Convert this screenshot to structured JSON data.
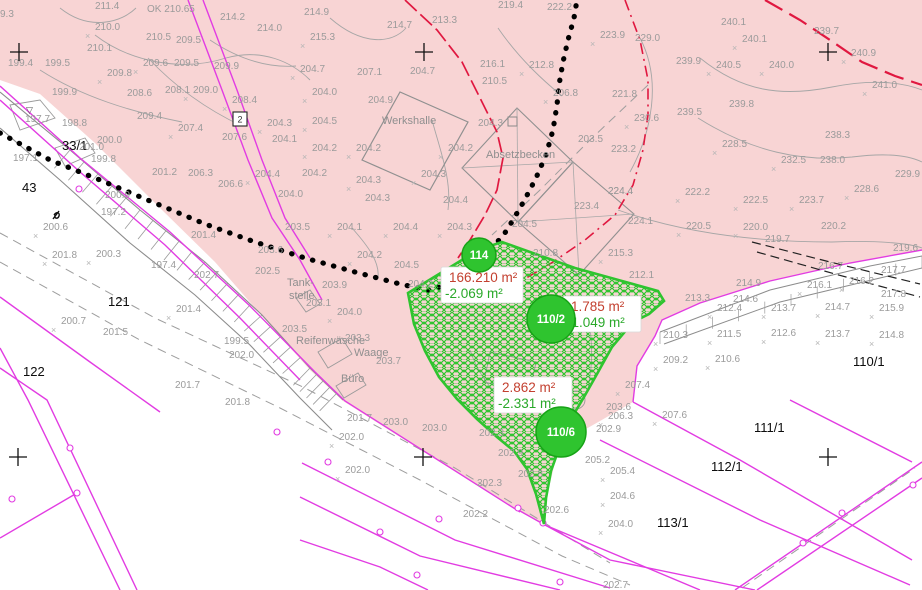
{
  "app": {
    "title": "Kataster-/Lageplan Kartenausschnitt"
  },
  "colors": {
    "background": "#ffffff",
    "area_fill_pink": "#f8d4d4",
    "parcel_line_magenta": "#e23ce2",
    "terrain_gray": "#9b9b9b",
    "survey_green": "#2fc42f",
    "area_label_red": "#c3402f",
    "area_label_green": "#29a829",
    "boundary_black": "#000000",
    "red_line": "#e01840"
  },
  "area_labels": [
    {
      "main": "166.210 m²",
      "delta": "-2.069 m²",
      "x": 441,
      "y": 267,
      "w": 82,
      "h": 36
    },
    {
      "main": "1.785 m²",
      "delta": "-1.049 m²",
      "x": 563,
      "y": 296,
      "w": 78,
      "h": 36
    },
    {
      "main": "2.862 m²",
      "delta": "-2.331 m²",
      "x": 494,
      "y": 377,
      "w": 78,
      "h": 36
    }
  ],
  "markers": {
    "circles": [
      {
        "label": "114",
        "x": 479,
        "y": 255,
        "r": 17
      },
      {
        "label": "110/2",
        "x": 551,
        "y": 319,
        "r": 24
      },
      {
        "label": "110/6",
        "x": 561,
        "y": 432,
        "r": 25
      }
    ],
    "grid_crosses": [
      {
        "x": 19,
        "y": 52
      },
      {
        "x": 424,
        "y": 52
      },
      {
        "x": 828,
        "y": 52
      },
      {
        "x": 18,
        "y": 457
      },
      {
        "x": 423,
        "y": 457
      },
      {
        "x": 828,
        "y": 457
      }
    ],
    "benchmark": {
      "glyph": "▽",
      "x": 31,
      "y": 113
    },
    "boxed_symbol": {
      "glyph": "2",
      "x": 233,
      "y": 112
    }
  },
  "labels": [
    {
      "t": "9.3",
      "x": 0,
      "y": 17,
      "c": "e"
    },
    {
      "t": "211.4",
      "x": 95,
      "y": 9,
      "c": "e"
    },
    {
      "t": "OK 210.65",
      "x": 147,
      "y": 12,
      "c": "ok"
    },
    {
      "t": "210.0",
      "x": 95,
      "y": 30,
      "c": "e",
      "m": 1
    },
    {
      "t": "214.2",
      "x": 220,
      "y": 20,
      "c": "e"
    },
    {
      "t": "214.0",
      "x": 257,
      "y": 31,
      "c": "e"
    },
    {
      "t": "210.5",
      "x": 146,
      "y": 40,
      "c": "e"
    },
    {
      "t": "209.5",
      "x": 176,
      "y": 43,
      "c": "e"
    },
    {
      "t": "210.1",
      "x": 87,
      "y": 51,
      "c": "e"
    },
    {
      "t": "199.4",
      "x": 8,
      "y": 66,
      "c": "e"
    },
    {
      "t": "199.5",
      "x": 45,
      "y": 66,
      "c": "e"
    },
    {
      "t": "209.6",
      "x": 143,
      "y": 66,
      "c": "e",
      "m": 1
    },
    {
      "t": "209.5",
      "x": 174,
      "y": 66,
      "c": "e"
    },
    {
      "t": "209.9",
      "x": 214,
      "y": 69,
      "c": "e"
    },
    {
      "t": "209.8",
      "x": 107,
      "y": 76,
      "c": "e",
      "m": 1
    },
    {
      "t": "199.9",
      "x": 52,
      "y": 95,
      "c": "e"
    },
    {
      "t": "208.6",
      "x": 127,
      "y": 96,
      "c": "e"
    },
    {
      "t": "208.1",
      "x": 165,
      "y": 93,
      "c": "e"
    },
    {
      "t": "209.0",
      "x": 193,
      "y": 93,
      "c": "e",
      "m": 1
    },
    {
      "t": "208.4",
      "x": 232,
      "y": 103,
      "c": "e",
      "m": 1
    },
    {
      "t": "209.4",
      "x": 137,
      "y": 119,
      "c": "e"
    },
    {
      "t": "197.7",
      "x": 25,
      "y": 122,
      "c": "e"
    },
    {
      "t": "198.8",
      "x": 62,
      "y": 126,
      "c": "e"
    },
    {
      "t": "207.4",
      "x": 178,
      "y": 131,
      "c": "e",
      "m": 1
    },
    {
      "t": "207.6",
      "x": 222,
      "y": 140,
      "c": "e"
    },
    {
      "t": "204.3",
      "x": 267,
      "y": 126,
      "c": "e",
      "m": 1
    },
    {
      "t": "204.1",
      "x": 272,
      "y": 142,
      "c": "e"
    },
    {
      "t": "200.0",
      "x": 97,
      "y": 143,
      "c": "e"
    },
    {
      "t": "33/1",
      "x": 62,
      "y": 150,
      "c": "p"
    },
    {
      "t": "201.0",
      "x": 79,
      "y": 150,
      "c": "e"
    },
    {
      "t": "197.1",
      "x": 13,
      "y": 161,
      "c": "e"
    },
    {
      "t": "199.8",
      "x": 91,
      "y": 162,
      "c": "e"
    },
    {
      "t": "43",
      "x": 22,
      "y": 192,
      "c": "p"
    },
    {
      "t": "200.9",
      "x": 105,
      "y": 198,
      "c": "e"
    },
    {
      "t": "204.4",
      "x": 255,
      "y": 177,
      "c": "e",
      "m": 1
    },
    {
      "t": "206.6",
      "x": 218,
      "y": 187,
      "c": "e"
    },
    {
      "t": "206.3",
      "x": 188,
      "y": 176,
      "c": "e"
    },
    {
      "t": "201.2",
      "x": 152,
      "y": 175,
      "c": "e"
    },
    {
      "t": "204.0",
      "x": 278,
      "y": 197,
      "c": "e"
    },
    {
      "t": "214.9",
      "x": 304,
      "y": 15,
      "c": "e"
    },
    {
      "t": "214.7",
      "x": 387,
      "y": 28,
      "c": "e"
    },
    {
      "t": "213.3",
      "x": 432,
      "y": 23,
      "c": "e"
    },
    {
      "t": "215.3",
      "x": 310,
      "y": 40,
      "c": "e",
      "m": 1
    },
    {
      "t": "219.4",
      "x": 498,
      "y": 8,
      "c": "e"
    },
    {
      "t": "222.2",
      "x": 547,
      "y": 10,
      "c": "e"
    },
    {
      "t": "216.1",
      "x": 480,
      "y": 67,
      "c": "e"
    },
    {
      "t": "212.8",
      "x": 529,
      "y": 68,
      "c": "e",
      "m": 1
    },
    {
      "t": "210.5",
      "x": 482,
      "y": 84,
      "c": "e"
    },
    {
      "t": "206.8",
      "x": 553,
      "y": 96,
      "c": "e",
      "m": 1
    },
    {
      "t": "204.7",
      "x": 300,
      "y": 72,
      "c": "e",
      "m": 1
    },
    {
      "t": "207.1",
      "x": 357,
      "y": 75,
      "c": "e"
    },
    {
      "t": "204.7",
      "x": 410,
      "y": 74,
      "c": "e"
    },
    {
      "t": "204.0",
      "x": 312,
      "y": 95,
      "c": "e",
      "m": 1
    },
    {
      "t": "204.9",
      "x": 368,
      "y": 103,
      "c": "e"
    },
    {
      "t": "204.5",
      "x": 312,
      "y": 124,
      "c": "e",
      "m": 1
    },
    {
      "t": "Werkshalle",
      "x": 382,
      "y": 124,
      "c": "b"
    },
    {
      "t": "204.3",
      "x": 478,
      "y": 126,
      "c": "e"
    },
    {
      "t": "203.5",
      "x": 578,
      "y": 142,
      "c": "e"
    },
    {
      "t": "204.2",
      "x": 312,
      "y": 151,
      "c": "e",
      "m": 1
    },
    {
      "t": "204.2",
      "x": 356,
      "y": 151,
      "c": "e",
      "m": 1
    },
    {
      "t": "204.2",
      "x": 448,
      "y": 151,
      "c": "e",
      "m": 1
    },
    {
      "t": "Absetzbecken",
      "x": 486,
      "y": 158,
      "c": "b"
    },
    {
      "t": "223.2",
      "x": 611,
      "y": 152,
      "c": "e"
    },
    {
      "t": "204.2",
      "x": 302,
      "y": 176,
      "c": "e"
    },
    {
      "t": "204.3",
      "x": 356,
      "y": 183,
      "c": "e",
      "m": 1
    },
    {
      "t": "204.3",
      "x": 421,
      "y": 177,
      "c": "e",
      "m": 1
    },
    {
      "t": "204.3",
      "x": 365,
      "y": 201,
      "c": "e"
    },
    {
      "t": "204.4",
      "x": 443,
      "y": 203,
      "c": "e"
    },
    {
      "t": "223.4",
      "x": 574,
      "y": 209,
      "c": "e"
    },
    {
      "t": "224.4",
      "x": 608,
      "y": 194,
      "c": "e"
    },
    {
      "t": "223.9",
      "x": 600,
      "y": 38,
      "c": "e",
      "m": 1
    },
    {
      "t": "229.0",
      "x": 635,
      "y": 41,
      "c": "e"
    },
    {
      "t": "240.1",
      "x": 721,
      "y": 25,
      "c": "e"
    },
    {
      "t": "240.1",
      "x": 742,
      "y": 42,
      "c": "e",
      "m": 1
    },
    {
      "t": "239.7",
      "x": 814,
      "y": 34,
      "c": "e"
    },
    {
      "t": "240.9",
      "x": 851,
      "y": 56,
      "c": "e",
      "m": 1
    },
    {
      "t": "239.9",
      "x": 676,
      "y": 64,
      "c": "e"
    },
    {
      "t": "240.5",
      "x": 716,
      "y": 68,
      "c": "e",
      "m": 1
    },
    {
      "t": "240.0",
      "x": 769,
      "y": 68,
      "c": "e",
      "m": 1
    },
    {
      "t": "241.0",
      "x": 872,
      "y": 88,
      "c": "e",
      "m": 1
    },
    {
      "t": "221.8",
      "x": 612,
      "y": 97,
      "c": "e"
    },
    {
      "t": "239.5",
      "x": 677,
      "y": 115,
      "c": "e"
    },
    {
      "t": "230.6",
      "x": 634,
      "y": 121,
      "c": "e",
      "m": 1
    },
    {
      "t": "239.8",
      "x": 729,
      "y": 107,
      "c": "e"
    },
    {
      "t": "238.3",
      "x": 825,
      "y": 138,
      "c": "e"
    },
    {
      "t": "228.5",
      "x": 722,
      "y": 147,
      "c": "e",
      "m": 1
    },
    {
      "t": "232.5",
      "x": 781,
      "y": 163,
      "c": "e",
      "m": 1
    },
    {
      "t": "238.0",
      "x": 820,
      "y": 163,
      "c": "e"
    },
    {
      "t": "229.9",
      "x": 895,
      "y": 177,
      "c": "e"
    },
    {
      "t": "224.4",
      "x": 608,
      "y": 194,
      "c": "e"
    },
    {
      "t": "222.2",
      "x": 685,
      "y": 195,
      "c": "e",
      "m": 1
    },
    {
      "t": "222.5",
      "x": 743,
      "y": 203,
      "c": "e",
      "m": 1
    },
    {
      "t": "223.7",
      "x": 799,
      "y": 203,
      "c": "e",
      "m": 1
    },
    {
      "t": "228.6",
      "x": 854,
      "y": 192,
      "c": "e",
      "m": 1
    },
    {
      "t": "224.1",
      "x": 628,
      "y": 224,
      "c": "e"
    },
    {
      "t": "220.5",
      "x": 686,
      "y": 229,
      "c": "e",
      "m": 1
    },
    {
      "t": "220.0",
      "x": 743,
      "y": 230,
      "c": "e",
      "m": 1
    },
    {
      "t": "220.2",
      "x": 821,
      "y": 229,
      "c": "e"
    },
    {
      "t": "219.7",
      "x": 765,
      "y": 242,
      "c": "e"
    },
    {
      "t": "219.6",
      "x": 893,
      "y": 251,
      "c": "e"
    },
    {
      "t": "215.3",
      "x": 608,
      "y": 256,
      "c": "e",
      "m": 1
    },
    {
      "t": "212.1",
      "x": 629,
      "y": 278,
      "c": "e"
    },
    {
      "t": "216.7",
      "x": 818,
      "y": 269,
      "c": "e"
    },
    {
      "t": "217.7",
      "x": 881,
      "y": 273,
      "c": "e"
    },
    {
      "t": "214.9",
      "x": 736,
      "y": 286,
      "c": "e"
    },
    {
      "t": "213.3",
      "x": 685,
      "y": 301,
      "c": "e"
    },
    {
      "t": "214.6",
      "x": 733,
      "y": 302,
      "c": "e"
    },
    {
      "t": "216.1",
      "x": 807,
      "y": 288,
      "c": "e",
      "m": 1
    },
    {
      "t": "216.2",
      "x": 849,
      "y": 284,
      "c": "e",
      "m": 1
    },
    {
      "t": "217.8",
      "x": 881,
      "y": 297,
      "c": "e"
    },
    {
      "t": "212.4",
      "x": 717,
      "y": 311,
      "c": "e",
      "m": 1
    },
    {
      "t": "213.7",
      "x": 771,
      "y": 311,
      "c": "e",
      "m": 1
    },
    {
      "t": "214.7",
      "x": 825,
      "y": 310,
      "c": "e",
      "m": 1
    },
    {
      "t": "215.9",
      "x": 879,
      "y": 311,
      "c": "e",
      "m": 1
    },
    {
      "t": "210.3",
      "x": 663,
      "y": 338,
      "c": "e",
      "m": 1
    },
    {
      "t": "211.5",
      "x": 717,
      "y": 337,
      "c": "e",
      "m": 1
    },
    {
      "t": "212.6",
      "x": 771,
      "y": 336,
      "c": "e",
      "m": 1
    },
    {
      "t": "213.7",
      "x": 825,
      "y": 337,
      "c": "e",
      "m": 1
    },
    {
      "t": "214.8",
      "x": 879,
      "y": 338,
      "c": "e",
      "m": 1
    },
    {
      "t": "209.2",
      "x": 663,
      "y": 363,
      "c": "e",
      "m": 1
    },
    {
      "t": "210.6",
      "x": 715,
      "y": 362,
      "c": "e",
      "m": 1
    },
    {
      "t": "110/1",
      "x": 853,
      "y": 366,
      "c": "p"
    },
    {
      "t": "207.4",
      "x": 625,
      "y": 388,
      "c": "e",
      "m": 1
    },
    {
      "t": "210.8",
      "x": 533,
      "y": 256,
      "c": "e"
    },
    {
      "t": "203.9",
      "x": 322,
      "y": 288,
      "c": "e"
    },
    {
      "t": "204.2",
      "x": 408,
      "y": 287,
      "c": "e"
    },
    {
      "t": "203.1",
      "x": 306,
      "y": 306,
      "c": "e"
    },
    {
      "t": "204.0",
      "x": 337,
      "y": 315,
      "c": "e",
      "m": 1
    },
    {
      "t": "Tank-",
      "x": 287,
      "y": 286,
      "c": "b"
    },
    {
      "t": "stelle",
      "x": 289,
      "y": 299,
      "c": "b"
    },
    {
      "t": "203.5",
      "x": 282,
      "y": 332,
      "c": "e"
    },
    {
      "t": "Reifenwäsche",
      "x": 296,
      "y": 344,
      "c": "b"
    },
    {
      "t": "203.3",
      "x": 345,
      "y": 341,
      "c": "e"
    },
    {
      "t": "Waage",
      "x": 354,
      "y": 356,
      "c": "b"
    },
    {
      "t": "203.7",
      "x": 376,
      "y": 364,
      "c": "e"
    },
    {
      "t": "Büro",
      "x": 341,
      "y": 382,
      "c": "b"
    },
    {
      "t": "204.5",
      "x": 394,
      "y": 268,
      "c": "e"
    },
    {
      "t": "204.2",
      "x": 357,
      "y": 258,
      "c": "e",
      "m": 1
    },
    {
      "t": "204.1",
      "x": 337,
      "y": 230,
      "c": "e",
      "m": 1
    },
    {
      "t": "204.4",
      "x": 393,
      "y": 230,
      "c": "e",
      "m": 1
    },
    {
      "t": "204.3",
      "x": 447,
      "y": 230,
      "c": "e",
      "m": 1
    },
    {
      "t": "204.5",
      "x": 512,
      "y": 227,
      "c": "e"
    },
    {
      "t": "200.6",
      "x": 43,
      "y": 230,
      "c": "e",
      "m": 1
    },
    {
      "t": "197.2",
      "x": 101,
      "y": 215,
      "c": "e"
    },
    {
      "t": "201.8",
      "x": 52,
      "y": 258,
      "c": "e",
      "m": 1
    },
    {
      "t": "200.3",
      "x": 96,
      "y": 257,
      "c": "e",
      "m": 1
    },
    {
      "t": "197.4",
      "x": 151,
      "y": 268,
      "c": "e"
    },
    {
      "t": "201.4",
      "x": 191,
      "y": 238,
      "c": "e"
    },
    {
      "t": "202.7",
      "x": 194,
      "y": 278,
      "c": "e"
    },
    {
      "t": "203.5",
      "x": 285,
      "y": 230,
      "c": "e"
    },
    {
      "t": "203.6",
      "x": 258,
      "y": 253,
      "c": "e"
    },
    {
      "t": "202.5",
      "x": 255,
      "y": 274,
      "c": "e"
    },
    {
      "t": "121",
      "x": 108,
      "y": 306,
      "c": "p"
    },
    {
      "t": "201.4",
      "x": 176,
      "y": 312,
      "c": "e",
      "m": 1
    },
    {
      "t": "200.7",
      "x": 61,
      "y": 324,
      "c": "e",
      "m": 1
    },
    {
      "t": "201.5",
      "x": 103,
      "y": 335,
      "c": "e"
    },
    {
      "t": "122",
      "x": 23,
      "y": 376,
      "c": "p"
    },
    {
      "t": "199.5",
      "x": 224,
      "y": 344,
      "c": "e"
    },
    {
      "t": "202.0",
      "x": 229,
      "y": 358,
      "c": "e"
    },
    {
      "t": "201.7",
      "x": 175,
      "y": 388,
      "c": "e"
    },
    {
      "t": "201.8",
      "x": 225,
      "y": 405,
      "c": "e"
    },
    {
      "t": "201.7",
      "x": 347,
      "y": 421,
      "c": "e"
    },
    {
      "t": "203.0",
      "x": 383,
      "y": 425,
      "c": "e"
    },
    {
      "t": "203.0",
      "x": 422,
      "y": 431,
      "c": "e"
    },
    {
      "t": "202.0",
      "x": 339,
      "y": 440,
      "c": "e",
      "m": 1
    },
    {
      "t": "202.0",
      "x": 345,
      "y": 473,
      "c": "e",
      "m": 1
    },
    {
      "t": "202.3",
      "x": 479,
      "y": 436,
      "c": "e"
    },
    {
      "t": "202.9",
      "x": 498,
      "y": 456,
      "c": "e"
    },
    {
      "t": "202.8",
      "x": 518,
      "y": 477,
      "c": "e"
    },
    {
      "t": "202.3",
      "x": 477,
      "y": 486,
      "c": "e"
    },
    {
      "t": "202.2",
      "x": 463,
      "y": 517,
      "c": "e"
    },
    {
      "t": "202.6",
      "x": 544,
      "y": 513,
      "c": "e"
    },
    {
      "t": "202.9",
      "x": 596,
      "y": 432,
      "c": "e"
    },
    {
      "t": "205.2",
      "x": 585,
      "y": 463,
      "c": "e"
    },
    {
      "t": "205.4",
      "x": 610,
      "y": 474,
      "c": "e",
      "m": 1
    },
    {
      "t": "204.6",
      "x": 610,
      "y": 499,
      "c": "e",
      "m": 1
    },
    {
      "t": "204.0",
      "x": 608,
      "y": 527,
      "c": "e",
      "m": 1
    },
    {
      "t": "203.6",
      "x": 606,
      "y": 410,
      "c": "e"
    },
    {
      "t": "206.3",
      "x": 608,
      "y": 419,
      "c": "e",
      "m": 1
    },
    {
      "t": "207.6",
      "x": 662,
      "y": 418,
      "c": "e",
      "m": 1
    },
    {
      "t": "111/1",
      "x": 754,
      "y": 432,
      "c": "p"
    },
    {
      "t": "112/1",
      "x": 711,
      "y": 471,
      "c": "p"
    },
    {
      "t": "113/1",
      "x": 657,
      "y": 527,
      "c": "p"
    },
    {
      "t": "202.7",
      "x": 603,
      "y": 588,
      "c": "e"
    }
  ]
}
